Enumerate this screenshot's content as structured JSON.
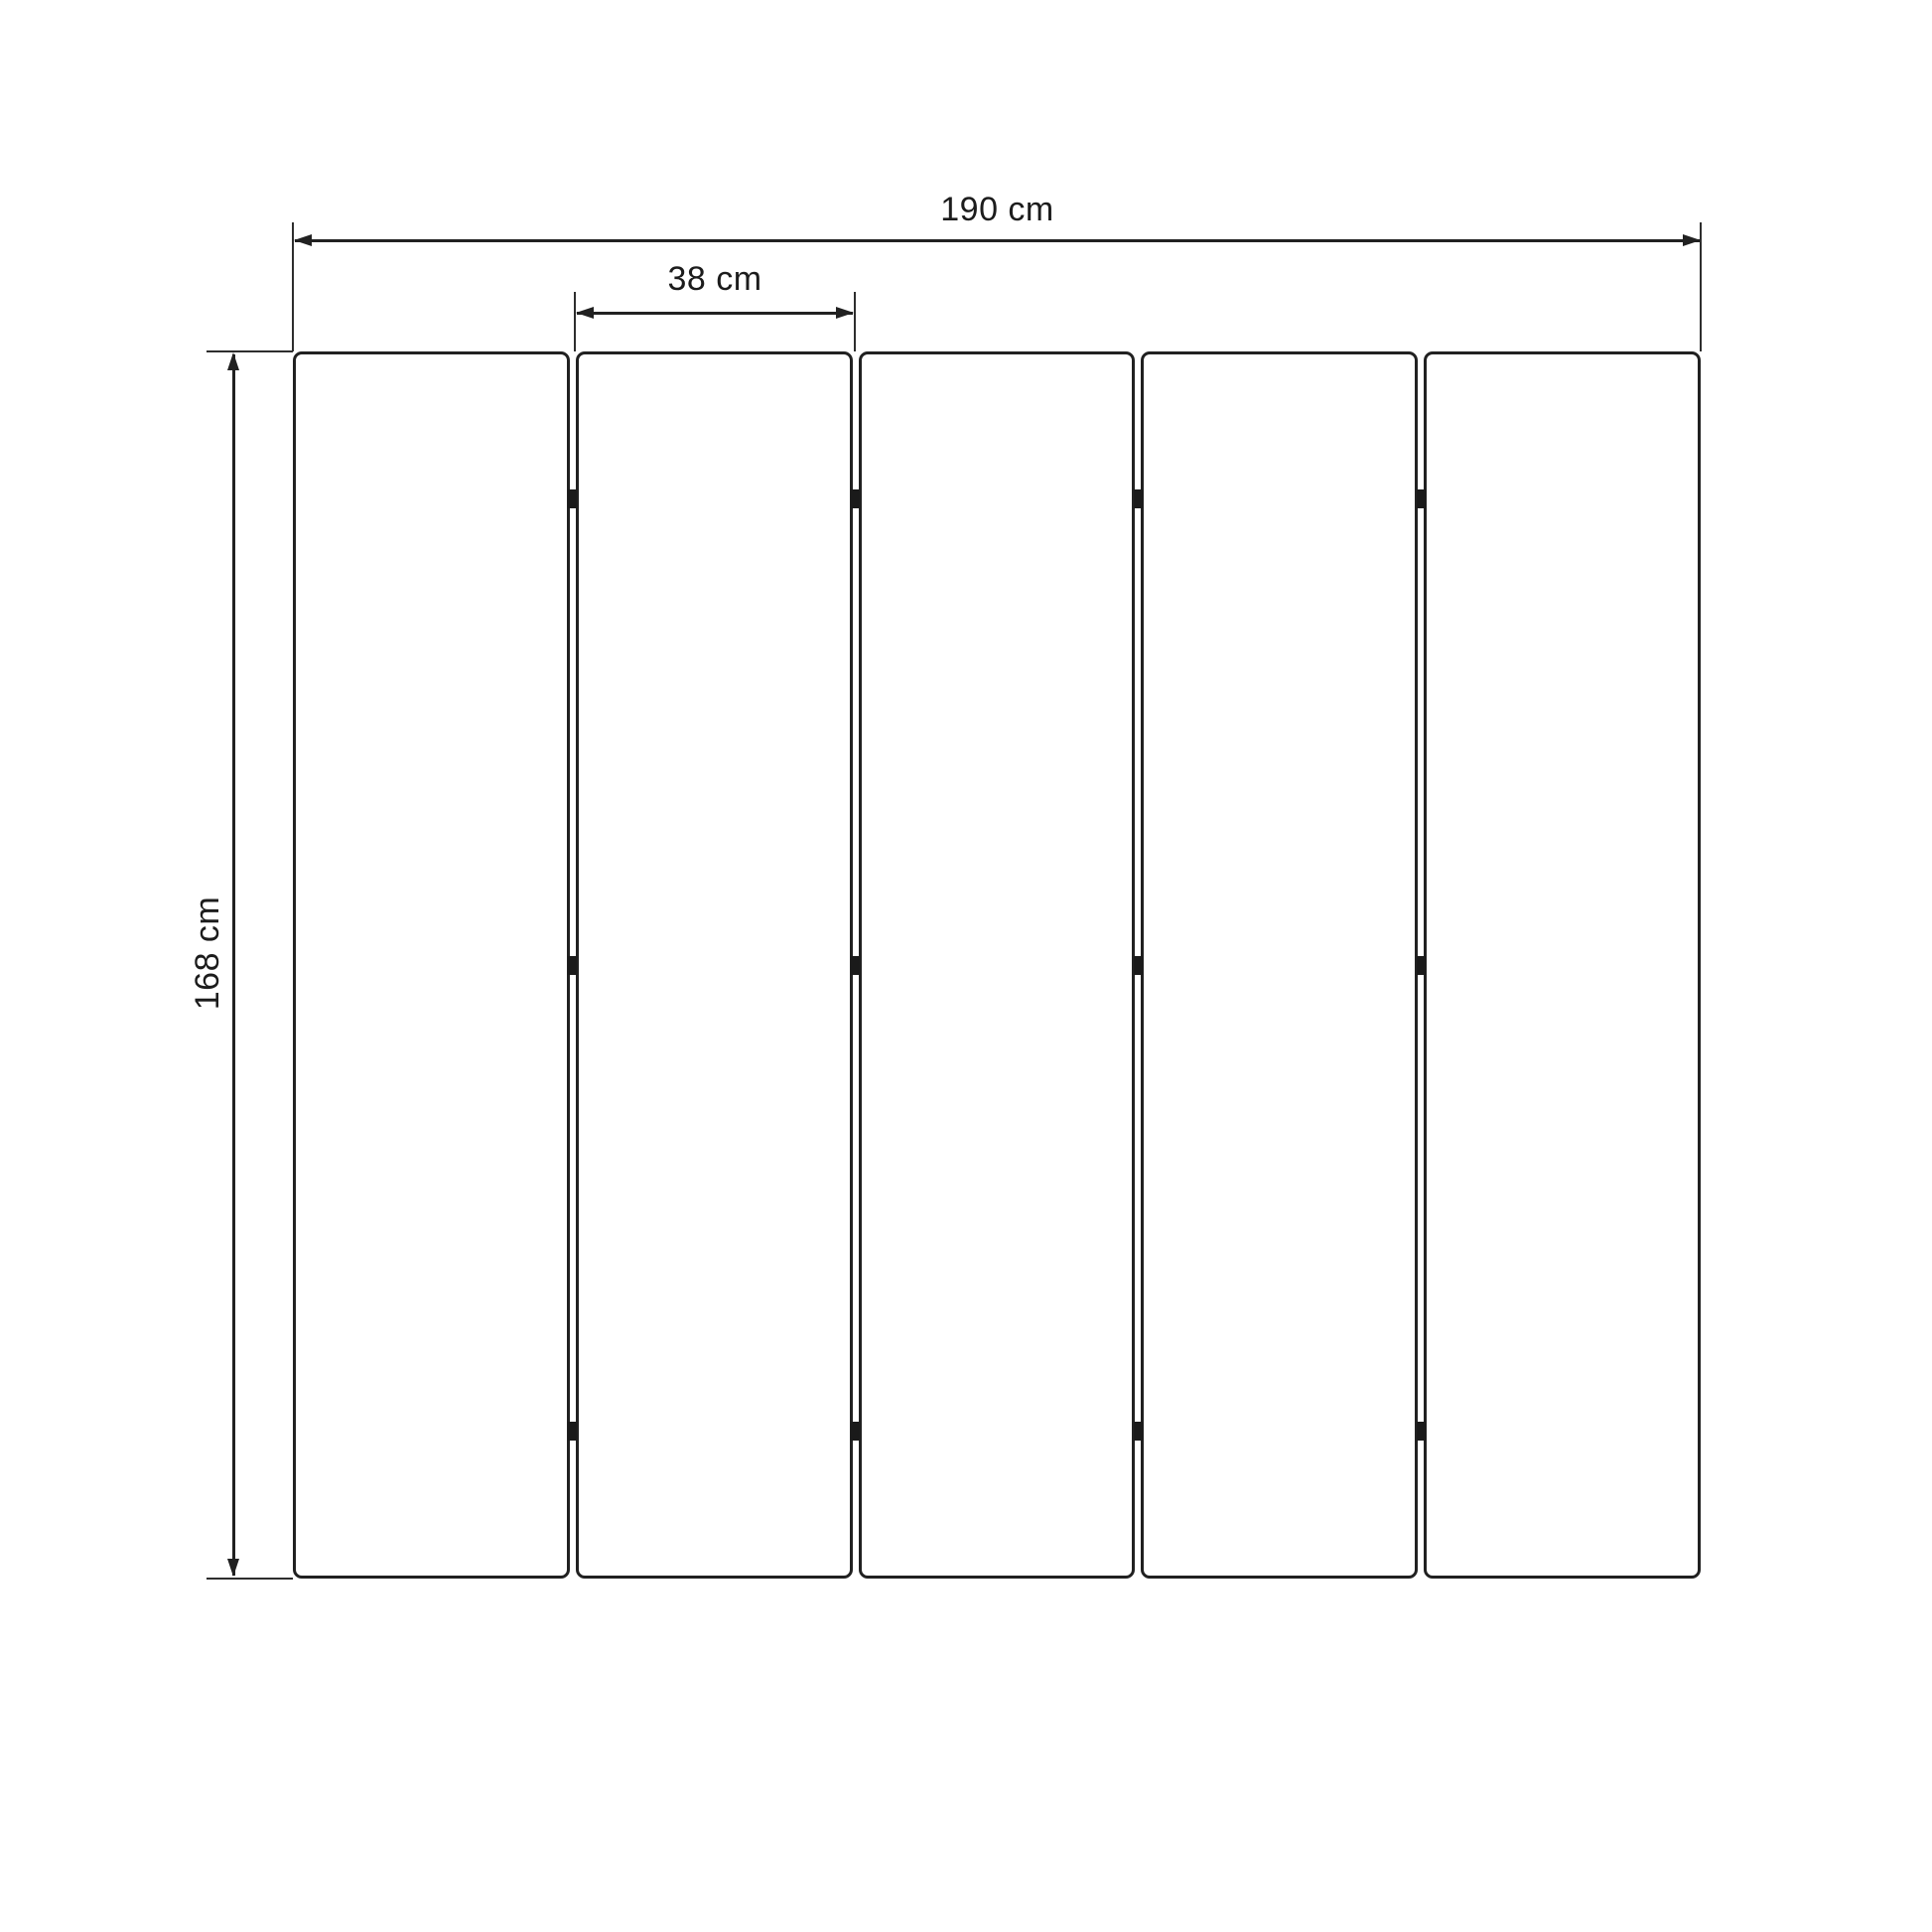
{
  "diagram": {
    "type": "dimension-drawing",
    "subject": "five-panel folding screen, front elevation",
    "background_color": "#ffffff",
    "line_color": "#212121",
    "panels": {
      "count": 5,
      "hinges_per_gap": 3
    },
    "dimensions": {
      "total_width_label": "190 cm",
      "panel_width_label": "38 cm",
      "height_label": "168 cm"
    }
  }
}
